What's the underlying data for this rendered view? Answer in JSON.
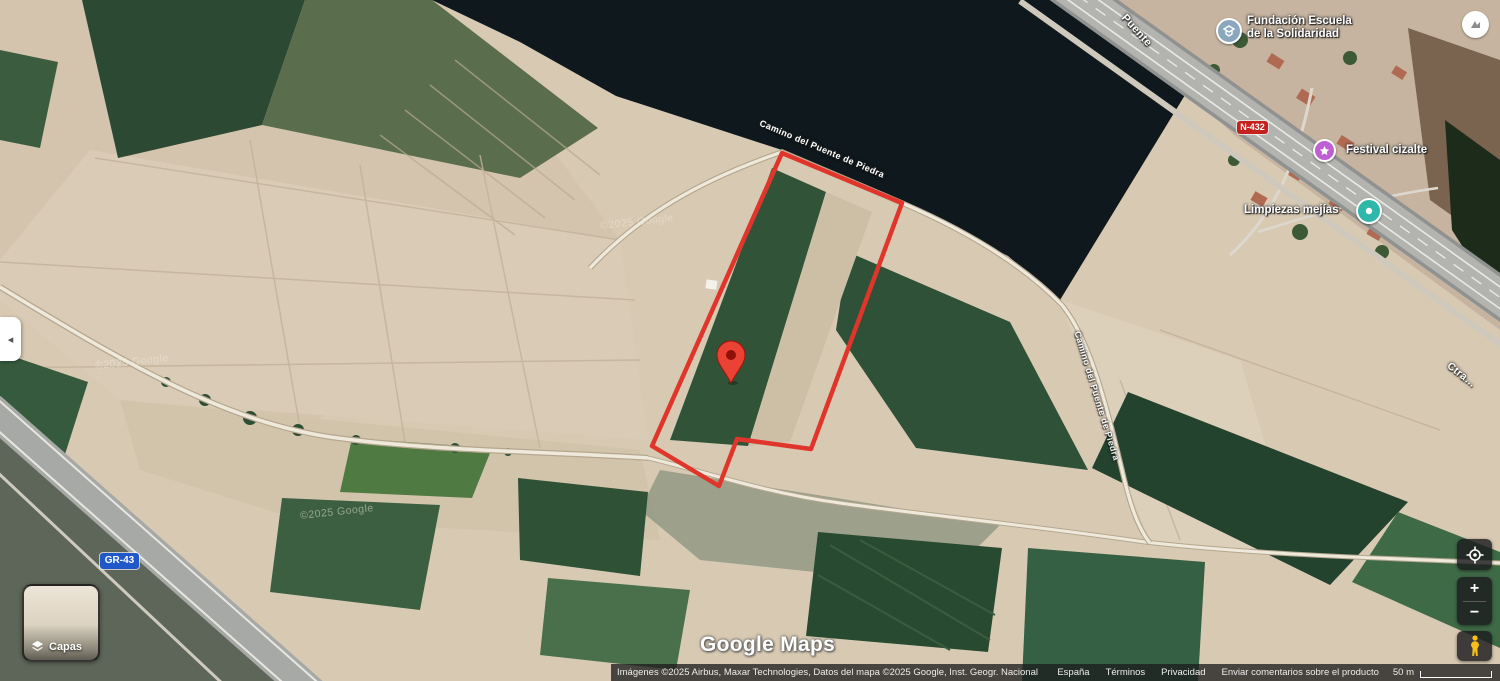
{
  "page": {
    "width": 1500,
    "height": 681,
    "view": "satellite"
  },
  "branding": {
    "logo_text": "Google Maps",
    "watermark": "©2025 Google"
  },
  "attribution": {
    "imagery": "Imágenes ©2025 Airbus, Maxar Technologies, Datos del mapa ©2025 Google, Inst. Geogr. Nacional",
    "links": [
      {
        "label": "España"
      },
      {
        "label": "Términos"
      },
      {
        "label": "Privacidad"
      },
      {
        "label": "Enviar comentarios sobre el producto"
      }
    ],
    "scale_label": "50 m"
  },
  "pois": [
    {
      "name": "Fundación Escuela de la Solidaridad",
      "line1": "Fundación Escuela",
      "line2": "de la Solidaridad",
      "icon": "school-icon",
      "icon_color": "#8aa7bd"
    },
    {
      "name": "Festival cizalte",
      "icon": "event-icon",
      "icon_color": "#bf5fd3"
    },
    {
      "name": "Limpiezas mejías",
      "icon": "services-icon",
      "icon_color": "#2fb8aa"
    }
  ],
  "roads": {
    "camino": "Camino del Puente de Piedra",
    "puente": "Puente",
    "ctra": "Ctra…",
    "badges": [
      {
        "label": "N-432",
        "color": "#c5221f"
      },
      {
        "label": "GR-43",
        "color": "#2057c9"
      }
    ]
  },
  "controls": {
    "layers_label": "Capas",
    "zoom_in": "+",
    "zoom_out": "−",
    "collapse_glyph": "◂"
  },
  "overlay": {
    "parcel_outline_color": "#e0352b",
    "marker_color": "#ea4335"
  }
}
